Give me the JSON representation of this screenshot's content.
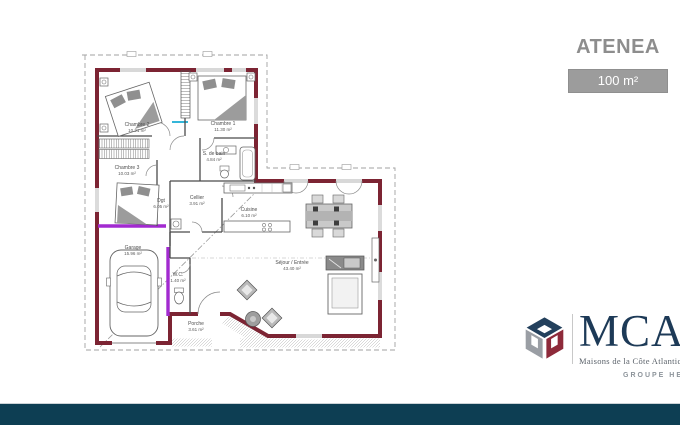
{
  "title": "ATENEA",
  "area_label": "100 m²",
  "plan": {
    "rooms": [
      {
        "name": "Chambre 2",
        "area": "10.21 m²"
      },
      {
        "name": "Chambre 1",
        "area": "11.30 m²"
      },
      {
        "name": "Chambre 3",
        "area": "10.03 m²"
      },
      {
        "name": "S. de bain",
        "area": "4.84 m²"
      },
      {
        "name": "Cellier",
        "area": "3.91 m²"
      },
      {
        "name": "Dgt",
        "area": "6.05 m²"
      },
      {
        "name": "Cuisine",
        "area": "6.10 m²"
      },
      {
        "name": "Garage",
        "area": "15.96 m²"
      },
      {
        "name": "W.C.",
        "area": "1.40 m²"
      },
      {
        "name": "Porche",
        "area": "3.61 m²"
      },
      {
        "name": "Séjour / Entrée",
        "area": "43.40 m²"
      }
    ]
  },
  "logo": {
    "name": "MCA",
    "subtitle": "Maisons de la Côte Atlantique",
    "group": "GROUPE HEXAOM"
  },
  "colors": {
    "wall": "#7c2433",
    "accent_purple": "#a22ad0",
    "accent_cyan": "#35b6d9",
    "title_gray": "#8d8d8d",
    "badge_bg": "#9c9c9c",
    "bottom_bar": "#0d3e53",
    "logo_navy": "#1d3a57",
    "logo_maroon": "#8e2a3a",
    "logo_gray": "#9a9ea4"
  }
}
